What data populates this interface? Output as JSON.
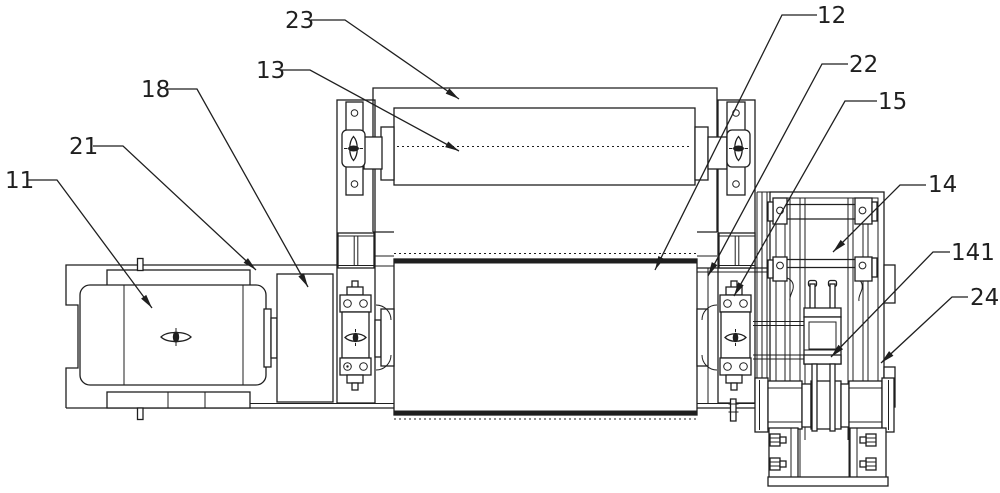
{
  "figure": {
    "type": "patent-technical-drawing",
    "width": 1000,
    "height": 493,
    "background": "#ffffff",
    "stroke_color": "#1f1f1f",
    "callouts": [
      {
        "text": "23",
        "text_x": 285,
        "text_y": 28,
        "path": [
          [
            311,
            20
          ],
          [
            345,
            20
          ],
          [
            459,
            99
          ]
        ]
      },
      {
        "text": "13",
        "text_x": 256,
        "text_y": 78,
        "path": [
          [
            281,
            70
          ],
          [
            310,
            70
          ],
          [
            459,
            151
          ]
        ]
      },
      {
        "text": "18",
        "text_x": 141,
        "text_y": 97,
        "path": [
          [
            165,
            89
          ],
          [
            197,
            89
          ],
          [
            308,
            287
          ]
        ]
      },
      {
        "text": "21",
        "text_x": 69,
        "text_y": 154,
        "path": [
          [
            93,
            146
          ],
          [
            123,
            146
          ],
          [
            256,
            270
          ]
        ]
      },
      {
        "text": "11",
        "text_x": 5,
        "text_y": 188,
        "path": [
          [
            28,
            180
          ],
          [
            57,
            180
          ],
          [
            152,
            308
          ]
        ]
      },
      {
        "text": "12",
        "text_x": 817,
        "text_y": 23,
        "path": [
          [
            817,
            15
          ],
          [
            782,
            15
          ],
          [
            655,
            270
          ]
        ]
      },
      {
        "text": "22",
        "text_x": 849,
        "text_y": 72,
        "path": [
          [
            848,
            64
          ],
          [
            822,
            64
          ],
          [
            708,
            276
          ]
        ]
      },
      {
        "text": "15",
        "text_x": 878,
        "text_y": 109,
        "path": [
          [
            877,
            101
          ],
          [
            845,
            101
          ],
          [
            734,
            296
          ]
        ]
      },
      {
        "text": "14",
        "text_x": 928,
        "text_y": 192,
        "path": [
          [
            926,
            185
          ],
          [
            900,
            185
          ],
          [
            833,
            252
          ]
        ]
      },
      {
        "text": "141",
        "text_x": 951,
        "text_y": 260,
        "path": [
          [
            950,
            252
          ],
          [
            933,
            252
          ],
          [
            831,
            357
          ]
        ]
      },
      {
        "text": "24",
        "text_x": 970,
        "text_y": 305,
        "path": [
          [
            968,
            297
          ],
          [
            952,
            297
          ],
          [
            881,
            363
          ]
        ]
      }
    ]
  }
}
